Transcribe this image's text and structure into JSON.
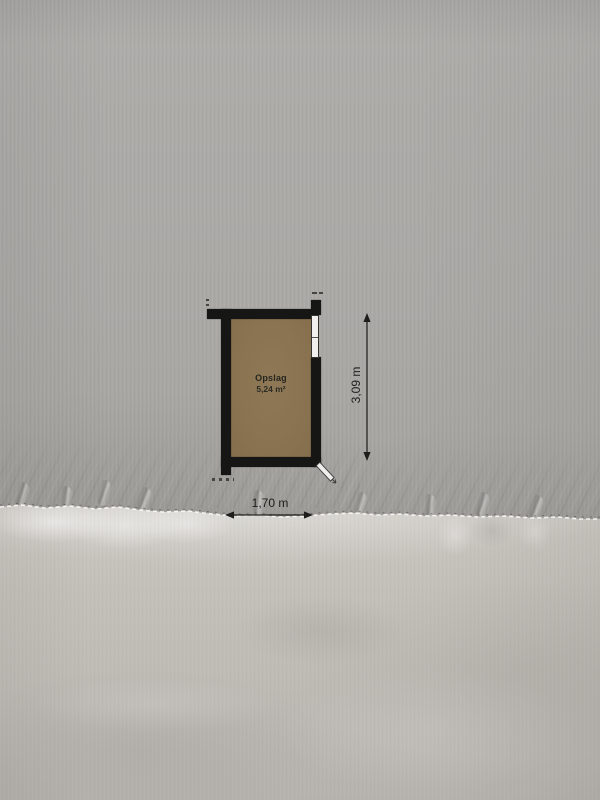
{
  "floorplan": {
    "room": {
      "name": "Opslag",
      "area": "5,24 m²"
    },
    "dimensions": {
      "width": "1,70 m",
      "height": "3,09 m"
    },
    "symbols": [
      "window-symbol",
      "door-swing-symbol",
      "dimension-arrows"
    ],
    "colors": {
      "wall": "#161614",
      "room_fill": "#8a7351",
      "dimension_ink": "#1d1d1b",
      "paper_top": "#a9a7a3",
      "paper_bottom": "#c1beb8"
    }
  }
}
